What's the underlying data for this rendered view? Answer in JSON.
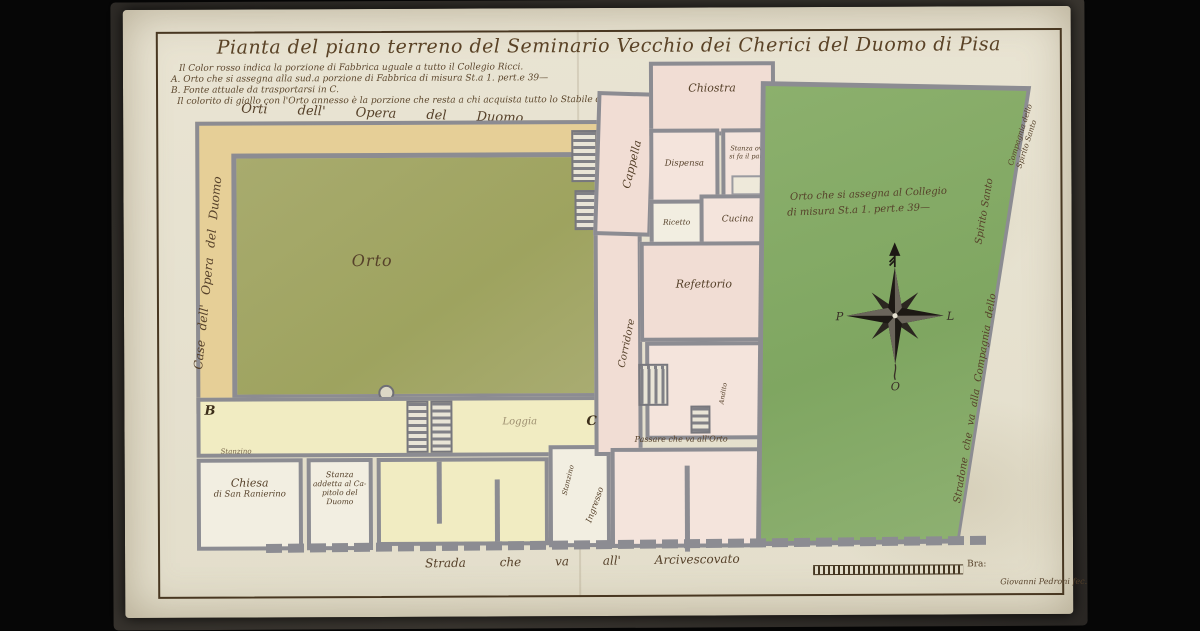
{
  "document": {
    "title": "Pianta del piano terreno del Seminario Vecchio dei Cherici del Duomo di Pisa",
    "signature": "Giovanni Pedroni fec.",
    "scale_label": "Bra:"
  },
  "legend": {
    "line1": "Il Color rosso indica la porzione di Fabbrica uguale a tutto il Collegio Ricci.",
    "line2": "A. Orto che si assegna alla sud.a porzione di Fabbrica di misura St.a 1. pert.e 39—",
    "line3": "B. Fonte attuale da trasportarsi in C.",
    "line4": "Il colorito di giallo con l'Orto annesso è la porzione che resta a chi acquista tutto lo Stabile del Seminario"
  },
  "streets": {
    "top_gardens": "Orti dell' Opera del Duomo",
    "left_houses": "Case dell' Opera del Duomo",
    "bottom": "Strada che va all' Arcivescovato",
    "right_road_1": "Stradone che va alla Compagnia dello",
    "right_road_2": "Spirito Santo",
    "corner_line1": "Compagnia dello",
    "corner_line2": "Spirito Santo"
  },
  "rooms": {
    "orto_left": "Orto",
    "cappella": "Cappella",
    "chiostra": "Chiostra",
    "dispensa": "Dispensa",
    "stanza_pane_l1": "Stanza ove",
    "stanza_pane_l2": "si fa il pane",
    "cucina": "Cucina",
    "ricetto": "Ricetto",
    "refettorio": "Refettorio",
    "corridore": "Corridore",
    "andito": "Andito",
    "loggia": "Loggia",
    "stanzino_a": "Stanzino",
    "stanzino_b": "Stanzino",
    "ingresso": "Ingresso",
    "chiesa_l1": "Chiesa",
    "chiesa_l2": "di San Ranierino",
    "capitolo_l1": "Stanza",
    "capitolo_l2": "addetta al Ca-",
    "capitolo_l3": "pitolo del Duomo",
    "passare": "Passare che va all'Orto",
    "orto_right_l1": "Orto che si assegna al Collegio",
    "orto_right_l2": "di misura St.a 1. pert.e 39—"
  },
  "markers": {
    "b": "B",
    "c": "C"
  },
  "compass": {
    "west": "P",
    "east": "L",
    "south": "O"
  },
  "colors": {
    "paper": "#e7e2d1",
    "ink": "#56412a",
    "wall_gray": "#8c8c92",
    "garden_olive": "#a4a766",
    "garden_green": "#83aa66",
    "band_tan": "#e6cf97",
    "rooms_yellow": "#f1ecc2",
    "rooms_pink": "#f1ddd4",
    "background": "#060606"
  }
}
